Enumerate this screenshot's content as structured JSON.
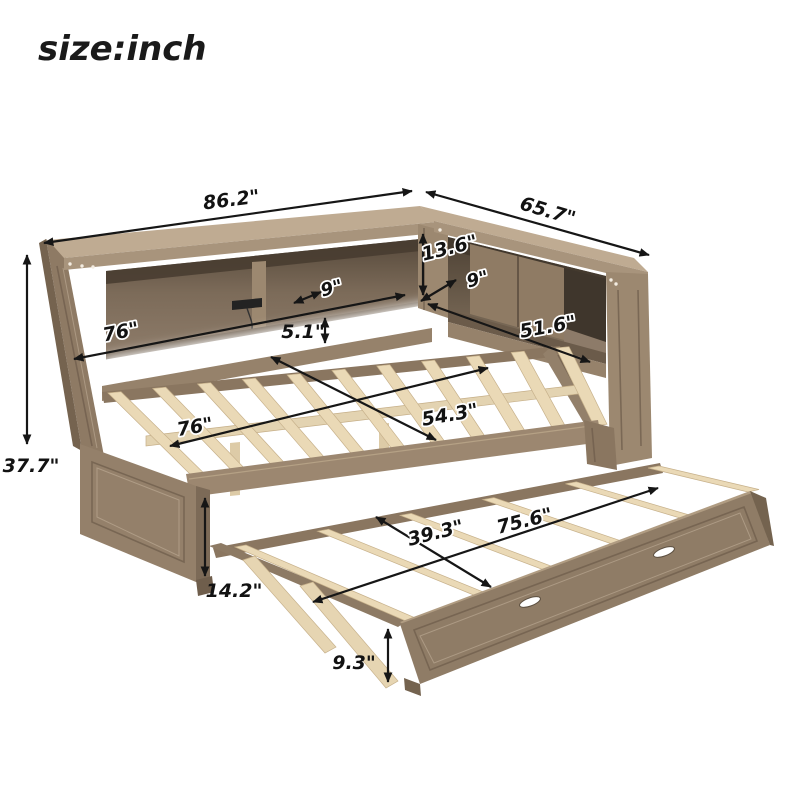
{
  "title": "size:inch",
  "dimensions": {
    "bookcase_long_length": "86.2\"",
    "bookcase_short_length": "65.7\"",
    "opening_height": "13.6\"",
    "shelf_depth_left": "9\"",
    "shelf_depth_right": "9\"",
    "left_shelf_width": "76\"",
    "base_strip_height": "5.1\"",
    "right_shelf_width": "51.6\"",
    "bed_length": "76\"",
    "bed_width": "54.3\"",
    "overall_height": "37.7\"",
    "end_panel_height": "14.2\"",
    "trundle_width": "39.3\"",
    "trundle_length": "75.6\"",
    "trundle_height": "9.3\""
  },
  "colors": {
    "background": "#ffffff",
    "wood_top": "#bda990",
    "wood_front": "#a08b74",
    "wood_dark": "#7c6a57",
    "interior_dark": "#564a3c",
    "slat": "#ead9b6",
    "led_strip": "#ffffff",
    "annotation": "#161616"
  }
}
